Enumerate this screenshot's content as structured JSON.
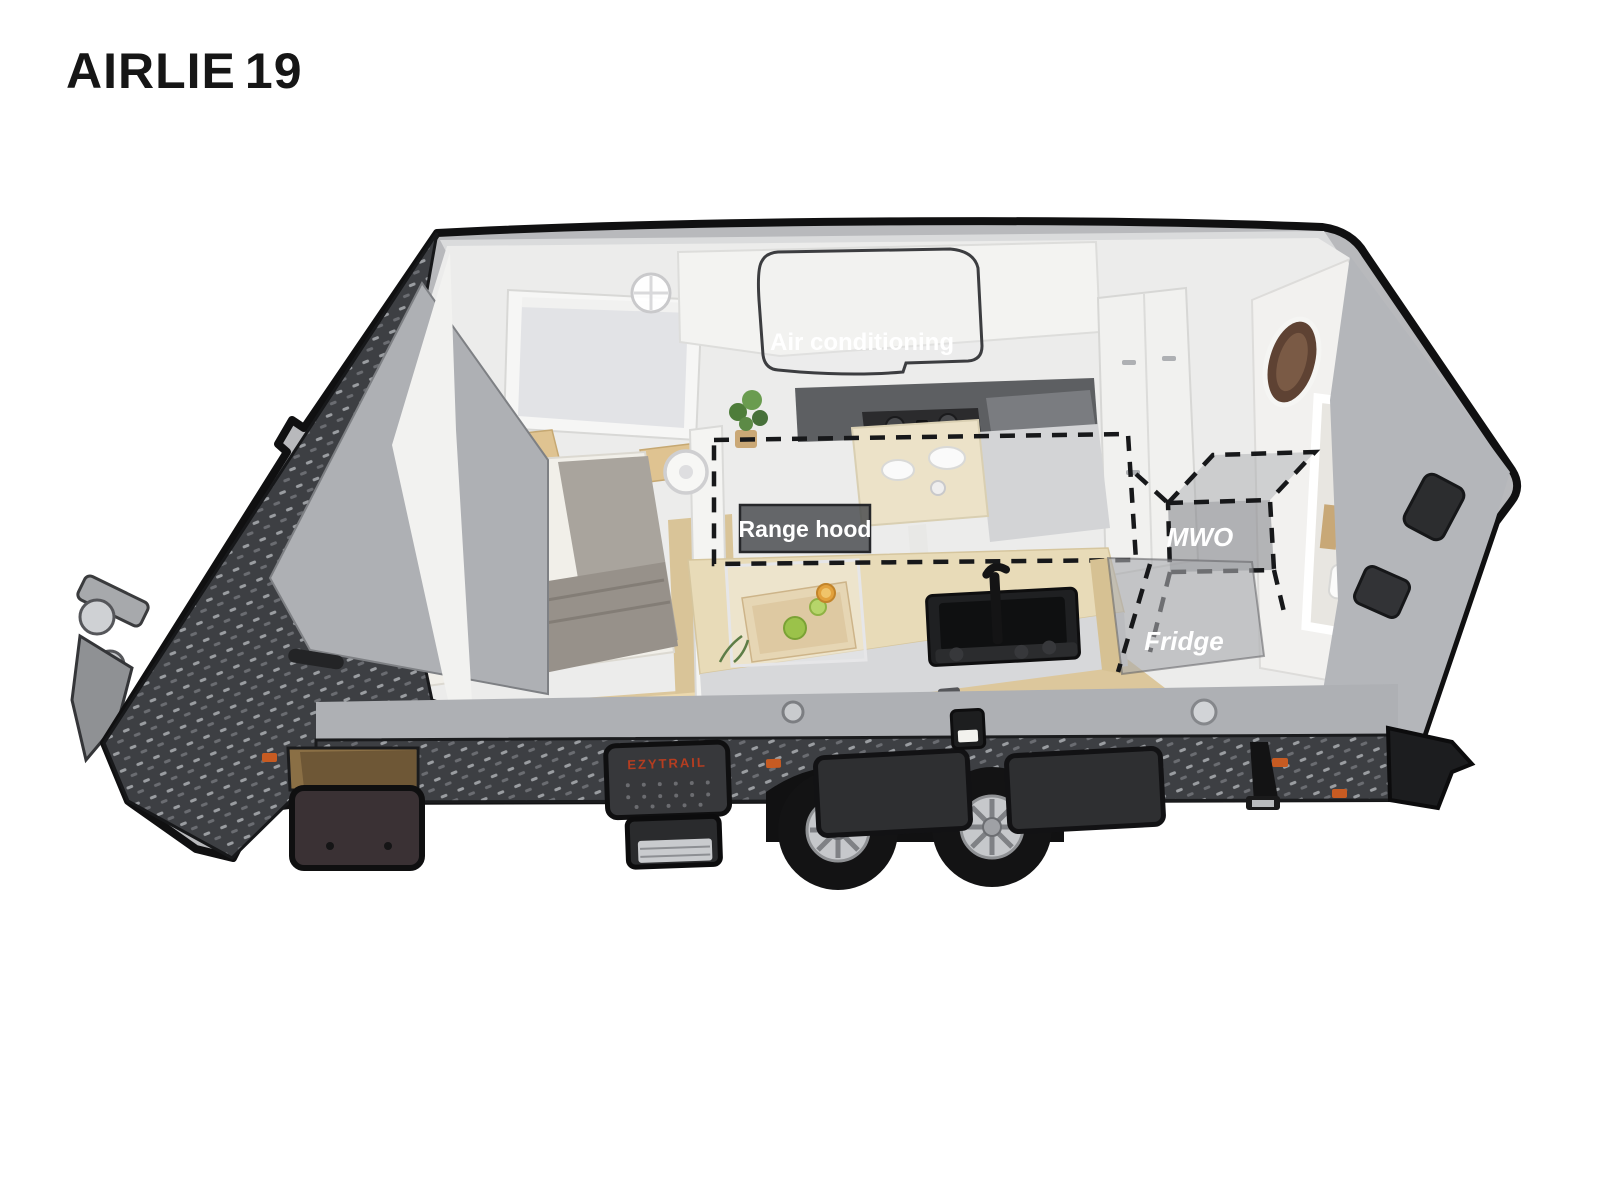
{
  "header": {
    "title_main": "AIRLIE",
    "title_number": "19"
  },
  "callouts": {
    "air_conditioning": "Air conditioning",
    "range_hood": "Range hood",
    "microwave": "MWO",
    "fridge": "Fridge"
  },
  "branding": {
    "mattress_logo": "EZYTRAIL",
    "mattress_tagline": "A home for your adventures",
    "entry_step_logo": "EZYTRAIL"
  },
  "colors": {
    "body_gray": "#b8b9bc",
    "checkerplate_dark": "#3d3f43",
    "accent_orange": "#e8951e",
    "reflector_orange": "#c75b22",
    "callout_text": "#ffffff",
    "outline_black": "#101011",
    "wood_floor": "#dcc79c"
  }
}
